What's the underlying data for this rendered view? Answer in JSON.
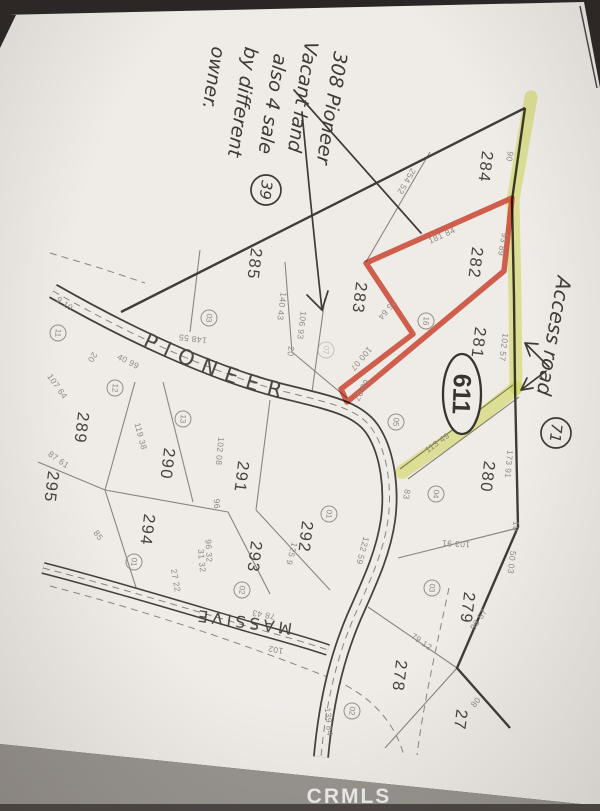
{
  "note": {
    "l1": "308 Pioneer",
    "l2": "Vacant land",
    "l3": "also 4 sale",
    "l4": "by different",
    "l5": "owner.",
    "circled": "39"
  },
  "access": {
    "label": "Access road",
    "circled": "71",
    "route_oval": "611"
  },
  "roads": {
    "pioneer": "PIONEER",
    "massive": "MASSIVE"
  },
  "watermark": "CRMLS",
  "colors": {
    "highlight_yellow": "#dde76a",
    "outline_red": "#d9503c",
    "paper": "#efece8"
  },
  "parcels": {
    "p284": "284",
    "p282": "282",
    "p283": "283",
    "p285": "285",
    "p281": "281",
    "p280": "280",
    "p279": "279",
    "p278": "278",
    "p27": "27",
    "p289": "289",
    "p290": "290",
    "p291": "291",
    "p292": "292",
    "p293": "293",
    "p294": "294",
    "p295": "295"
  },
  "lots": {
    "c03a": "03",
    "c11": "11",
    "c12": "12",
    "c13": "13",
    "c07": "07",
    "c16": "16",
    "c05": "05",
    "c04": "04",
    "c01a": "01",
    "c01b": "01",
    "c02a": "02",
    "c03b": "03",
    "c02b": "02"
  },
  "dims": {
    "d90": "90",
    "d9389": "93 89",
    "d18184": "181 84",
    "d25452": "254 52",
    "d14043": "140 43",
    "d10693": "106 93",
    "d20a": "20",
    "d7564": "75 64",
    "d14855": "148 55",
    "d10007": "100 07",
    "d6007": "60 07",
    "d11349": "113 49",
    "d10257": "102 57",
    "d17391": "173 91",
    "d10": "10",
    "d5003": "50 03",
    "d10391": "103 91",
    "d9857": "98 57",
    "d80": "80",
    "d7912": "79 12",
    "d13984": "139 84",
    "d12259": "122 59",
    "d1259": "125 9",
    "d7843": "78 43",
    "d102": "102",
    "d2722": "27 22",
    "d85": "85",
    "d9632": "96 32",
    "d96": "96",
    "d11938": "119 38",
    "d10208": "102 08",
    "d10764": "107 64",
    "d8761": "87 61",
    "d4099": "40 99",
    "d910": "9 10",
    "d20b": "20",
    "d83": "83",
    "d3132": "31 32"
  }
}
